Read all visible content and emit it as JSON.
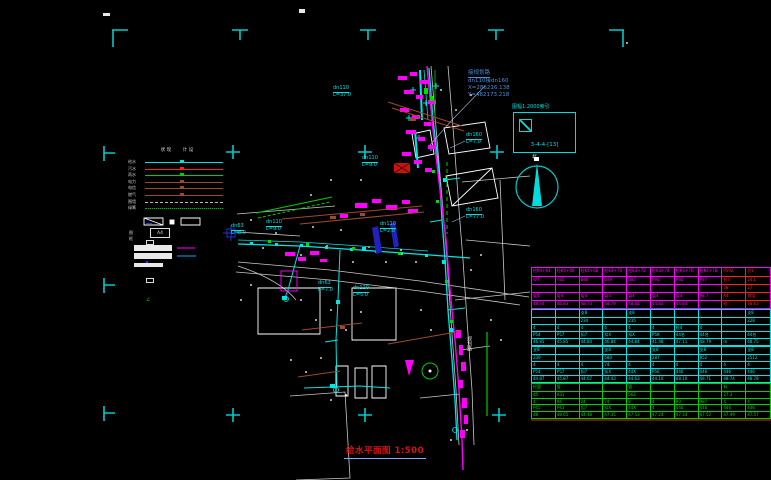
{
  "title": {
    "text": "给水平面图 1:500"
  },
  "north": {
    "label": "北"
  },
  "annotation": {
    "line1": "接规划路",
    "line2": "dn110接dn160",
    "line3": "X=286216.138",
    "line4": "Y=482173.218"
  },
  "index_box": {
    "label": "图幅1:2000索引",
    "code": "3-4-4-[13]"
  },
  "legend": {
    "col_headers": [
      "现状",
      "设计"
    ],
    "rows": [
      {
        "label": "给水",
        "color": "#00e0e0",
        "style": "solid",
        "marker": true
      },
      {
        "label": "污水",
        "color": "#ff2020",
        "style": "solid",
        "marker": true
      },
      {
        "label": "雨水",
        "color": "#00d000",
        "style": "solid",
        "marker": true
      },
      {
        "label": "电力",
        "color": "#9c4a2f",
        "style": "solid",
        "marker": true
      },
      {
        "label": "电信",
        "color": "#9c4a2f",
        "style": "solid",
        "marker": true
      },
      {
        "label": "燃气",
        "color": "#9c4a2f",
        "style": "solid",
        "marker": true
      },
      {
        "label": "围墙",
        "color": "#bbbbbb",
        "style": "dashed",
        "marker": false
      },
      {
        "label": "绿篱",
        "color": "#00b000",
        "style": "dotted",
        "marker": false
      }
    ],
    "symbols_label": "附属",
    "angle_glyph": "∠",
    "frame_label": "图框",
    "frame_text": "A4"
  },
  "pipe_labels": [
    {
      "lines": [
        "dn110",
        "L=37.0"
      ],
      "x": 333,
      "y": 86
    },
    {
      "lines": [
        "dn110",
        "L=9.0"
      ],
      "x": 362,
      "y": 156
    },
    {
      "lines": [
        "dn160",
        "L=7.0"
      ],
      "x": 466,
      "y": 133
    },
    {
      "lines": [
        "dn160",
        "L=77.0"
      ],
      "x": 466,
      "y": 208
    },
    {
      "lines": [
        "dn110",
        "L=9.0"
      ],
      "x": 266,
      "y": 220
    },
    {
      "lines": [
        "dn63",
        "L=8.0"
      ],
      "x": 231,
      "y": 224
    },
    {
      "lines": [
        "dn63",
        "L=7.0"
      ],
      "x": 318,
      "y": 281
    },
    {
      "lines": [
        "dn110",
        "L=5.0"
      ],
      "x": 353,
      "y": 286
    },
    {
      "lines": [
        "dn110",
        "L=2.0"
      ],
      "x": 380,
      "y": 222
    }
  ],
  "street_labels": [
    {
      "text": "规划路",
      "x": 466,
      "y": 336
    }
  ],
  "table": {
    "col_count": 10,
    "section_heights": [
      42,
      37,
      37,
      36
    ],
    "sections": [
      {
        "color": "#ff00ff",
        "red_from": 8,
        "red_color": "#ff2020",
        "rows": [
          [
            "检K4+64",
            "检K4+66",
            "检K4+68",
            "检K4+70",
            "检K4+72",
            "检K4+74",
            "检K4+76",
            "检K4+78",
            "P592",
            "总1"
          ],
          [
            "W7",
            "Y85",
            "B46",
            "B79",
            "B87",
            "P91",
            "P92",
            "P97",
            "检4",
            "24.1"
          ],
          [
            "",
            "",
            "",
            "",
            "",
            "",
            "",
            "",
            "38",
            "27"
          ],
          [
            "管4",
            "管4",
            "管4",
            "管4",
            "管4",
            "管4",
            "管4",
            "P8.7",
            "A4",
            "首组"
          ],
          [
            "48.74",
            "46.83",
            "48.73",
            "48.79",
            "48.81",
            "44.82",
            "44.84",
            "",
            "检",
            "48.63"
          ]
        ]
      },
      {
        "color": "#00e5e5",
        "rows": [
          [
            "",
            "",
            "支8",
            "",
            "支8",
            "",
            "",
            "",
            "",
            "支8"
          ],
          [
            "",
            "",
            "234",
            "",
            "235",
            "",
            "",
            "",
            "",
            "228"
          ],
          [
            "4",
            "4",
            "4",
            "4",
            "4",
            "4",
            "检4",
            "4",
            "",
            ""
          ],
          [
            "P54",
            "P57",
            "扣7",
            "扣X",
            "扣X",
            "P5K",
            "44名",
            "44名",
            "",
            "44名"
          ],
          [
            "46.85",
            "45.85",
            "44.84",
            "46.84",
            "44.84",
            "41.48",
            "47.11",
            "48.79",
            "m",
            "48.75"
          ]
        ]
      },
      {
        "color": "#00e5e5",
        "rows": [
          [
            "支8",
            "",
            "",
            "支8",
            "",
            "支8",
            "",
            "支8",
            "",
            "支8"
          ],
          [
            "239",
            "",
            "",
            "580",
            "",
            "287",
            "",
            "852",
            "",
            "2512"
          ],
          [
            "4",
            "4",
            "4",
            "74",
            "4",
            "4",
            "4",
            "4",
            "4",
            "4"
          ],
          [
            "P54",
            "P57",
            "扣7",
            "扣X",
            "44X",
            "P56",
            "446",
            "446",
            "446",
            "446"
          ],
          [
            "44.87",
            "45.87",
            "44.07",
            "44.43",
            "44.63",
            "44.10",
            "48.10",
            "48.71",
            "48.74",
            "48.78"
          ]
        ]
      },
      {
        "color": "#00d000",
        "rows": [
          [
            "检管",
            "管",
            "",
            "",
            "管",
            "",
            "",
            "",
            "料",
            ""
          ],
          [
            "45",
            "031",
            "",
            "",
            "562",
            "",
            "",
            "",
            "27.3",
            ""
          ],
          [
            "4",
            "94",
            "04",
            "74",
            "8",
            "4",
            "90",
            "987",
            "4",
            "4"
          ],
          [
            "P45",
            "P43",
            "扣7",
            "扣X",
            "44X",
            "4",
            "446",
            "446",
            "446",
            "446"
          ],
          [
            "48",
            "48.65",
            "44.48",
            "47.35",
            "47.53",
            "47.24",
            "47.34",
            "47.52",
            "47.49",
            "47.57"
          ]
        ]
      }
    ]
  }
}
